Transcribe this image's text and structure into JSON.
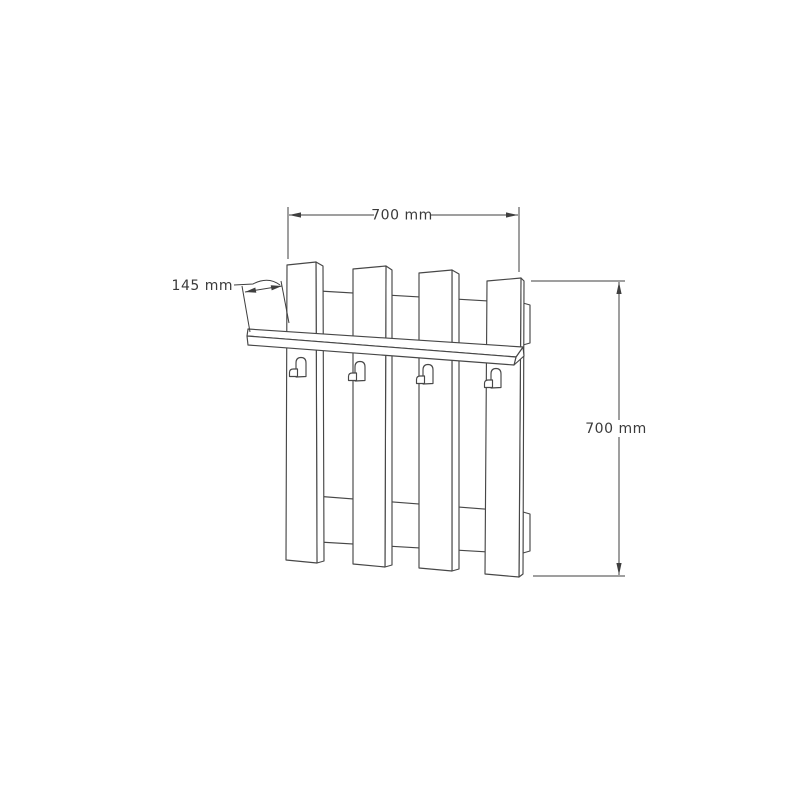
{
  "figure": {
    "type": "technical-drawing",
    "description": "Isometric line drawing of a wall-mounted coat rack: four vertical slats on two horizontal rails, a shelf across the front and four coat hooks",
    "labels": {
      "width": "700 mm",
      "height": "700 mm",
      "shelf_depth": "145 mm"
    },
    "colors": {
      "background": "#ffffff",
      "line": "#474747",
      "dimension": "#3f3f3f",
      "text": "#3a3a3a"
    }
  }
}
